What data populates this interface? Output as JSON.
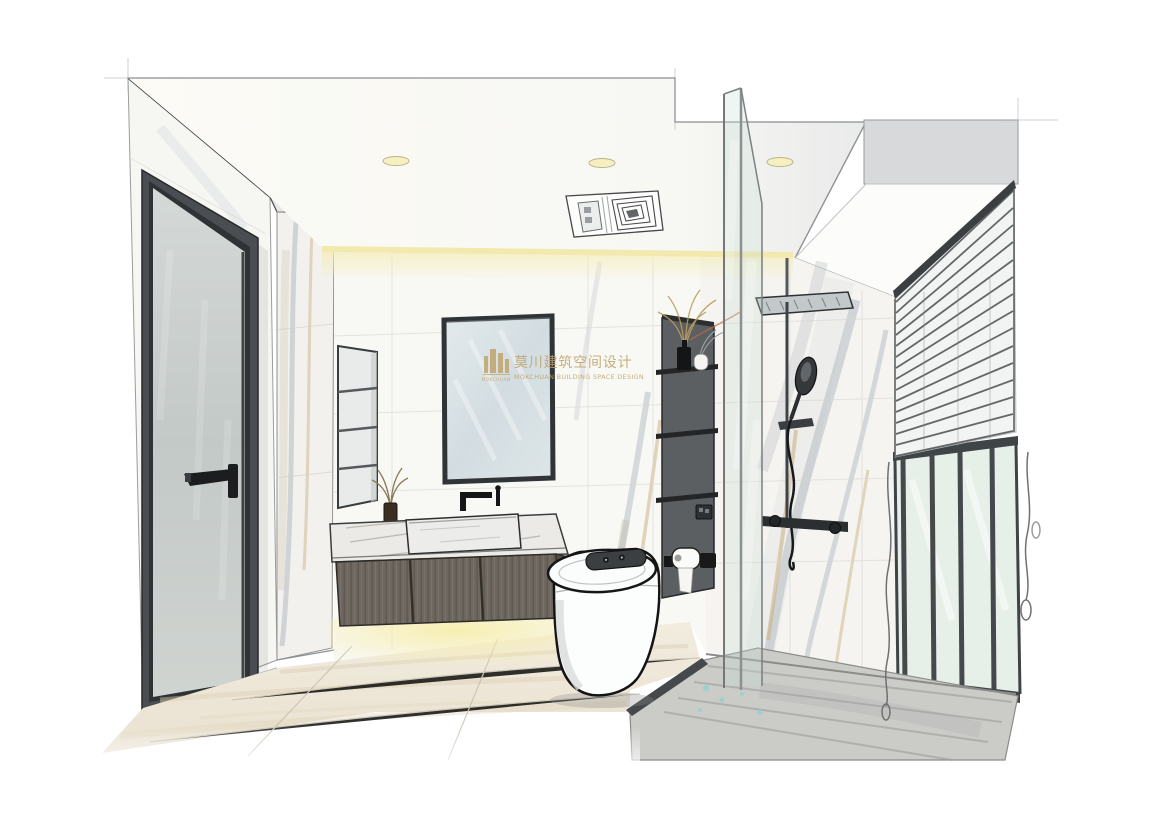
{
  "scene": {
    "kind": "interior-design-rendering",
    "room": "bathroom",
    "style": "hand-drawn marker-sketch perspective rendering"
  },
  "watermark": {
    "logo_text": "MOKCHUAN",
    "title_cn": "莫川建筑空间设计",
    "title_en": "MOKCHUAN BUILDING SPACE DESIGN",
    "color": "#bfa267"
  },
  "palette": {
    "background": "#ffffff",
    "wall_tile": "#f8f8f5",
    "marble_vein_gray": "#aeb5bd",
    "marble_vein_gold": "#c9ae7e",
    "cabinet_wood": "#6e6760",
    "niche_gray": "#5b5f62",
    "cove_light": "#f2e9ae",
    "window_glass": "#e7efe9",
    "floor_cream": "#efe8da",
    "shower_floor_gray": "#cbcbc8",
    "ink_line": "#2a2c2e"
  },
  "objects": [
    "recessed ceiling downlights",
    "ceiling ventilation / heater unit",
    "cove lighting strip",
    "frosted-glass door with black frame and lever handle",
    "small recessed wall niche with glass shelves",
    "black framed mirror",
    "wall-mounted black faucet",
    "aroma diffuser bottle",
    "floating wood vanity with marble top and vessel sink",
    "under-cabinet warm lighting",
    "white smart toilet with control panel",
    "tall dark storage niche with vases, dried plants, outlet and toilet-paper holder",
    "glass shower partition",
    "rain shower column with hand shower",
    "window with venetian blinds and pull cords",
    "cream stone tile floor",
    "gray stone shower floor"
  ]
}
